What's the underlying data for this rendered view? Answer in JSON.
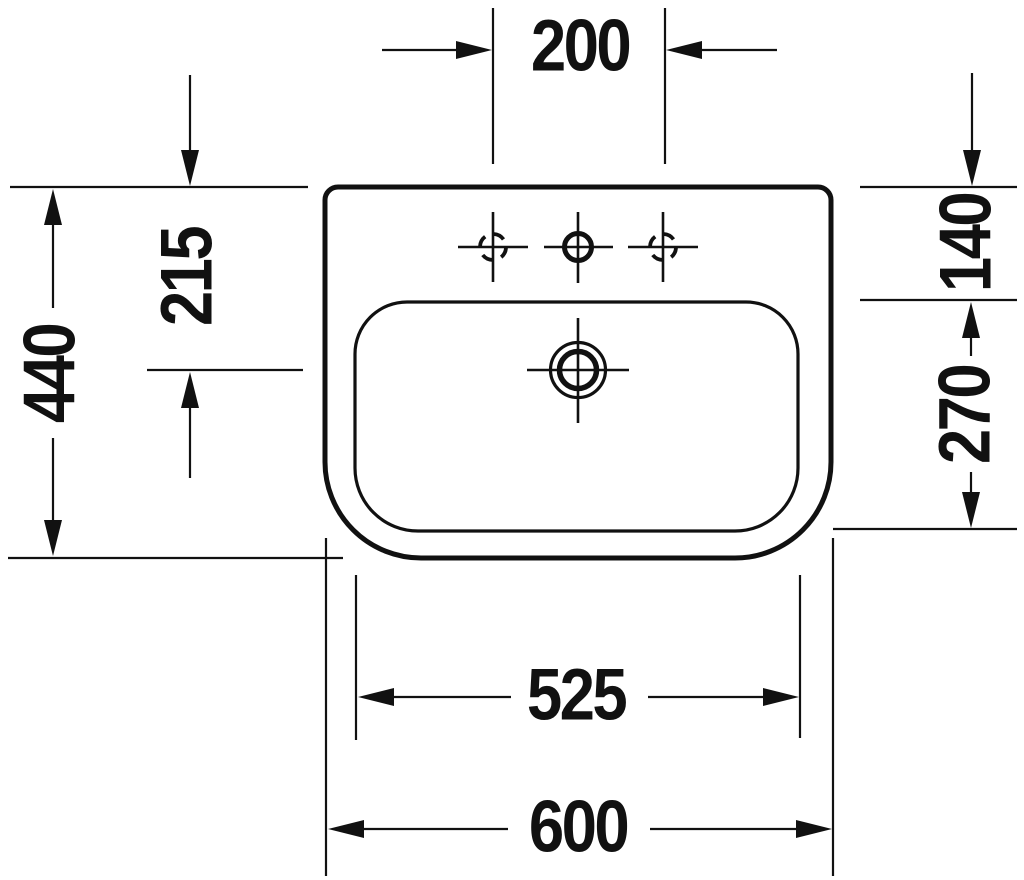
{
  "drawing": {
    "line_color": "#111111",
    "background_color": "#ffffff",
    "labels": {
      "tap_hole_spacing": "200",
      "overall_depth": "440",
      "drain_center_offset": "215",
      "rear_deck_depth": "140",
      "basin_inner_depth": "270",
      "basin_inner_width": "525",
      "overall_width": "600"
    }
  }
}
